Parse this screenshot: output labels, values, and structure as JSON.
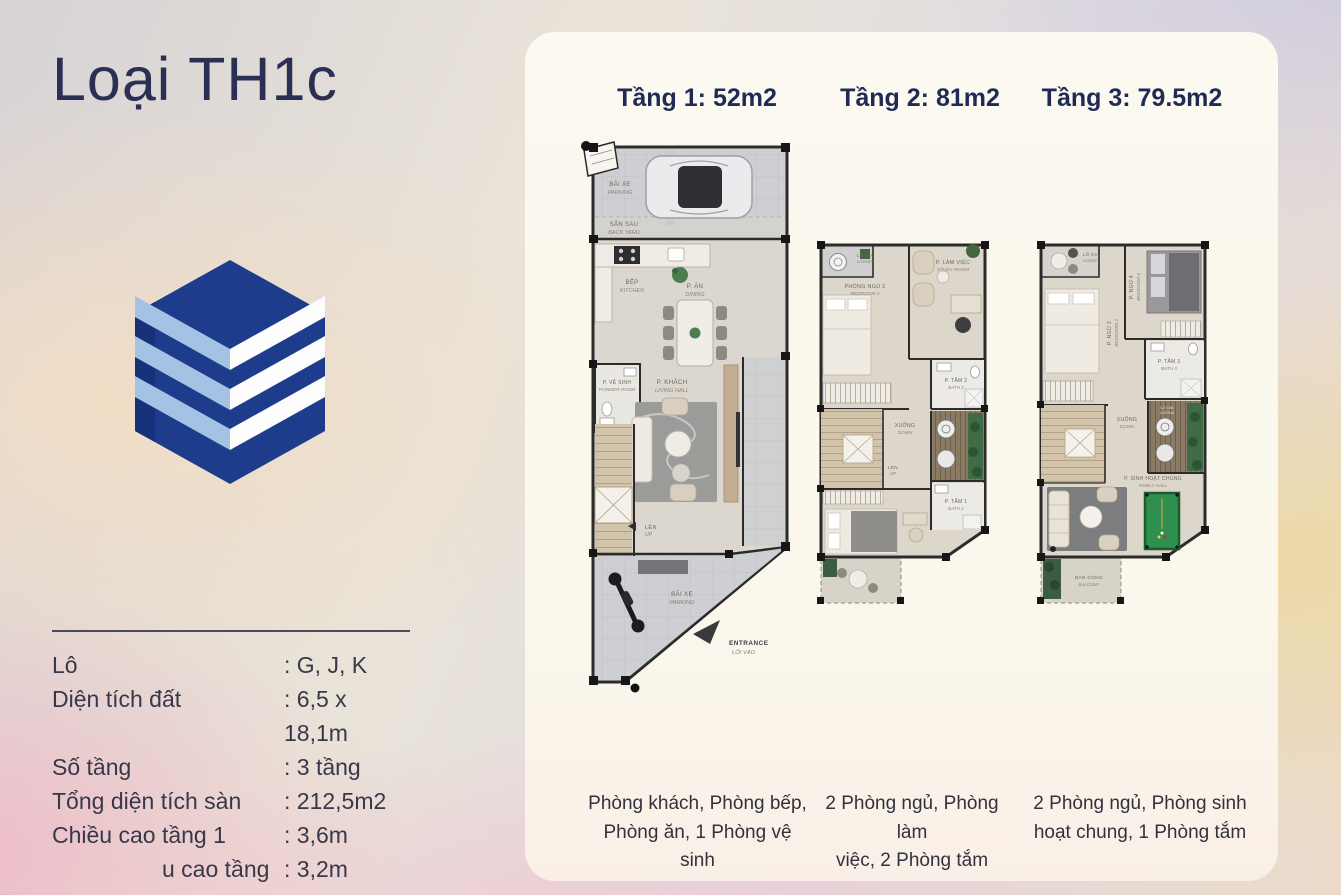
{
  "page": {
    "title": "Loại TH1c"
  },
  "colors": {
    "brand_navy": "#1e3c8c",
    "brand_light_blue": "#a4c2e4",
    "title_navy": "#2a3054",
    "card_cream": "#fbf8ee",
    "billiard_green": "#2f8f4e"
  },
  "specs": {
    "rows": [
      {
        "label": "Lô",
        "value": ": G, J, K"
      },
      {
        "label": "Diện tích đất",
        "value": ": 6,5 x 18,1m"
      },
      {
        "label": "Số tầng",
        "value": ": 3 tầng"
      },
      {
        "label": "Tổng diện tích sàn",
        "value": ": 212,5m2"
      },
      {
        "label": "Chiều cao tầng 1",
        "value": ": 3,6m"
      },
      {
        "label": "u cao tầng 2, 3",
        "value": ": 3,2m"
      }
    ]
  },
  "plans": [
    {
      "title": "Tầng 1: 52m2",
      "caption": "Phòng khách, Phòng bếp,\nPhòng ăn, 1 Phòng vệ sinh",
      "labels": {
        "parking_top_vi": "BÃI XE",
        "parking_top_en": "PARKING",
        "backyard_vi": "SÂN SAU",
        "backyard_en": "BACK YARD",
        "kitchen_vi": "BẾP",
        "kitchen_en": "KITCHEN",
        "dining_vi": "P. ĂN",
        "dining_en": "DINING",
        "powder_vi": "P. VỆ SINH",
        "powder_en": "POWDER ROOM",
        "living_vi": "P. KHÁCH",
        "living_en": "LIVING HALL",
        "up_vi": "LÊN",
        "up_en": "UP",
        "parking_bottom_vi": "BÃI XE",
        "parking_bottom_en": "PARKING",
        "entrance_en": "ENTRANCE",
        "entrance_vi": "LỐI VÀO"
      }
    },
    {
      "title": "Tầng 2: 81m2",
      "caption": "2 Phòng ngủ, Phòng làm\nviệc, 2 Phòng tắm",
      "labels": {
        "loggia_vi": "LÔ GIA",
        "loggia_en": "LOGGIA",
        "bedroom2_vi": "PHÒNG NGỦ 2",
        "bedroom2_en": "BEDROOM 2",
        "study_vi": "P. LÀM VIỆC",
        "study_en": "STUDY ROOM",
        "bath2_vi": "P. TẮM 2",
        "bath2_en": "BATH 2",
        "down_vi": "XUỐNG",
        "down_en": "DOWN",
        "up_vi": "LÊN",
        "up_en": "UP",
        "bath1_vi": "P. TẮM 1",
        "bath1_en": "BATH 1"
      }
    },
    {
      "title": "Tầng 3: 79.5m2",
      "caption": "2 Phòng ngủ, Phòng sinh\nhoạt chung, 1 Phòng tắm",
      "labels": {
        "loggia_vi": "LÔ GIA",
        "loggia_en": "LOGGIA",
        "bedroom3_vi": "P. NGỦ 3",
        "bedroom3_en": "BEDROOM 3",
        "bedroom4_vi": "P. NGỦ 4",
        "bedroom4_en": "BEDROOM 4",
        "bath3_vi": "P. TẮM 3",
        "bath3_en": "BATH 3",
        "down_vi": "XUỐNG",
        "down_en": "DOWN",
        "loggia2_vi": "LÔ GIA",
        "loggia2_en": "LOGGIA",
        "family_vi": "P. SINH HOẠT CHUNG",
        "family_en": "FAMILY HALL",
        "balcony_vi": "BAN CÔNG",
        "balcony_en": "BALCONY"
      }
    }
  ]
}
